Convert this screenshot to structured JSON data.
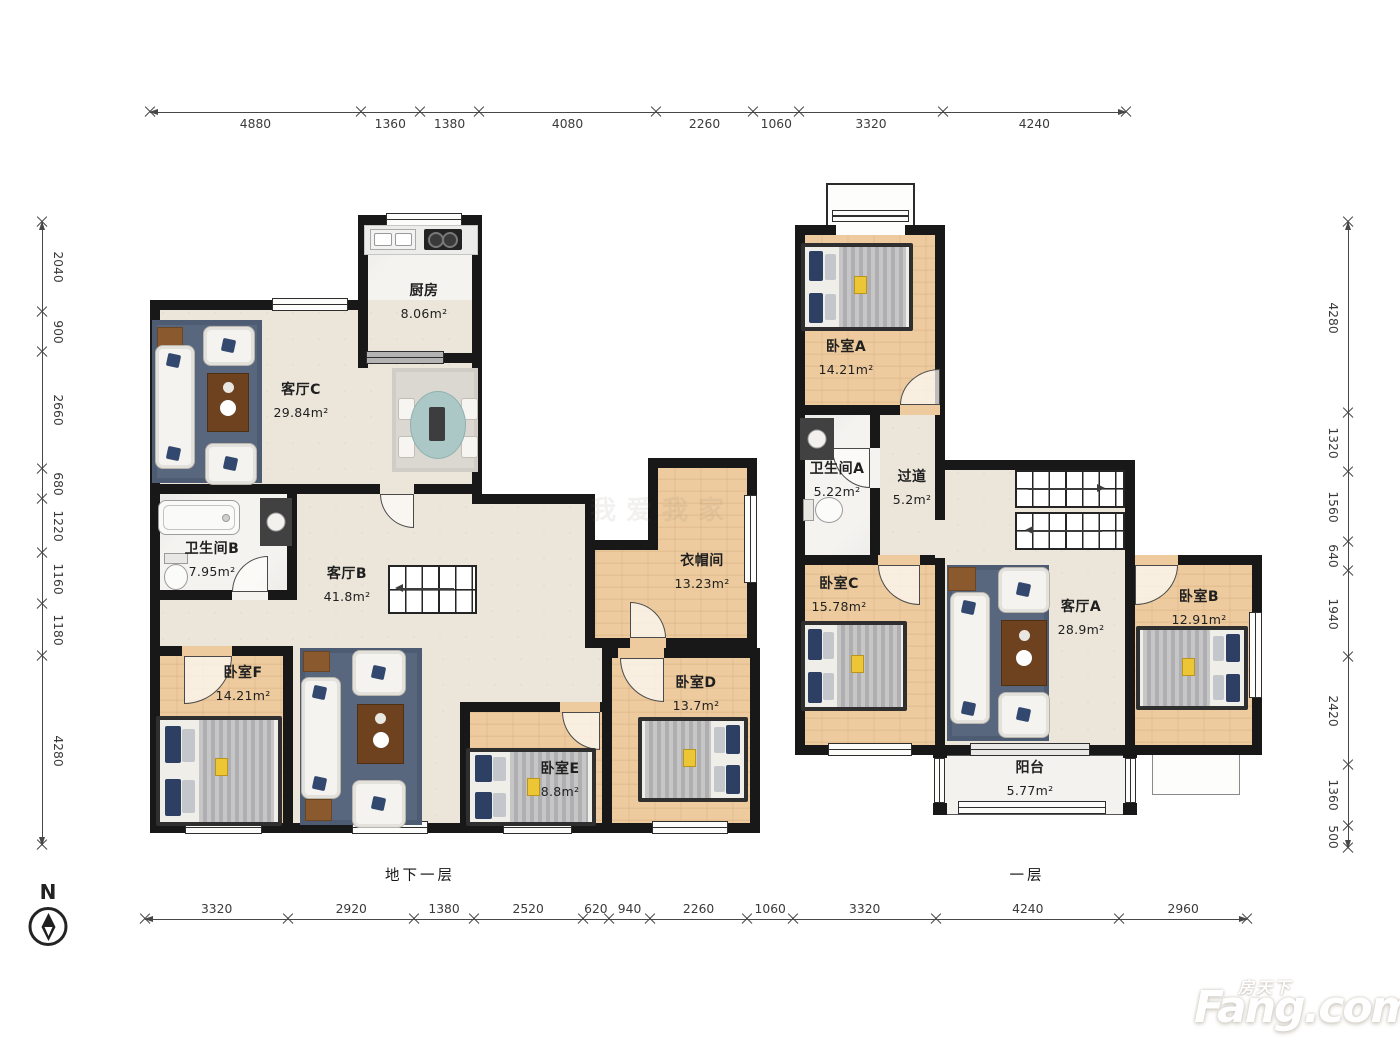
{
  "compass": {
    "label": "N"
  },
  "watermark": "我爱我家",
  "logo": {
    "cn": "房天下",
    "en": "Fang.com"
  },
  "floors": {
    "basement": "地下一层",
    "first": "一层"
  },
  "dimensions": {
    "top": [
      4880,
      1360,
      1380,
      4080,
      2260,
      1060,
      3320,
      4240
    ],
    "bottom": [
      3320,
      2920,
      1380,
      2520,
      620,
      940,
      2260,
      1060,
      3320,
      4240,
      2960
    ],
    "left": [
      2040,
      900,
      2660,
      680,
      1220,
      1160,
      1180,
      4280
    ],
    "right": [
      4280,
      1320,
      1560,
      640,
      1940,
      2420,
      1360,
      500
    ]
  },
  "rooms": {
    "basement": {
      "kitchen": {
        "name": "厨房",
        "area": "8.06m²"
      },
      "living_c": {
        "name": "客厅C",
        "area": "29.84m²"
      },
      "bath_b": {
        "name": "卫生间B",
        "area": "7.95m²"
      },
      "living_b": {
        "name": "客厅B",
        "area": "41.8m²"
      },
      "cloakroom": {
        "name": "衣帽间",
        "area": "13.23m²"
      },
      "bedroom_f": {
        "name": "卧室F",
        "area": "14.21m²"
      },
      "bedroom_e": {
        "name": "卧室E",
        "area": "8.8m²"
      },
      "bedroom_d": {
        "name": "卧室D",
        "area": "13.7m²"
      }
    },
    "first": {
      "bedroom_a": {
        "name": "卧室A",
        "area": "14.21m²"
      },
      "bath_a": {
        "name": "卫生间A",
        "area": "5.22m²"
      },
      "hallway": {
        "name": "过道",
        "area": "5.2m²"
      },
      "bedroom_c": {
        "name": "卧室C",
        "area": "15.78m²"
      },
      "living_a": {
        "name": "客厅A",
        "area": "28.9m²"
      },
      "bedroom_b": {
        "name": "卧室B",
        "area": "12.91m²"
      },
      "balcony": {
        "name": "阳台",
        "area": "5.77m²"
      }
    }
  }
}
